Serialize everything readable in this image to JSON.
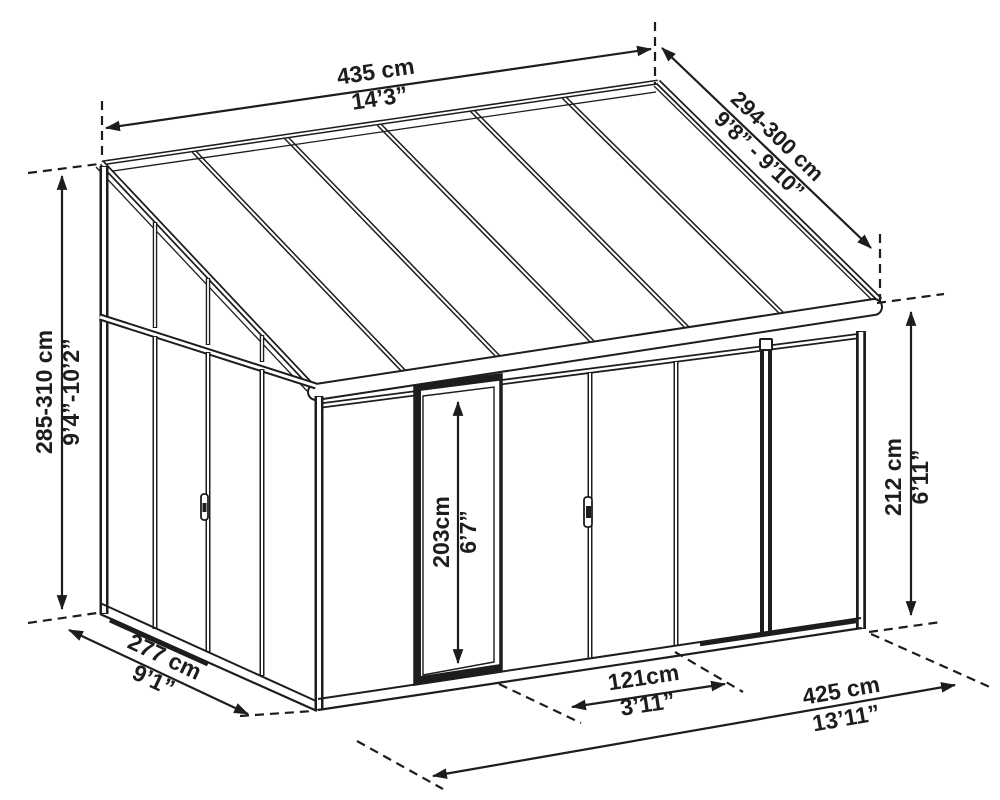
{
  "diagram": {
    "type": "sunroom-dimension-drawing",
    "colors": {
      "line": "#1d1d1b",
      "background": "#ffffff"
    },
    "dimensions": {
      "roof_width": {
        "metric": "435 cm",
        "imperial": "14’3”"
      },
      "roof_depth": {
        "metric": "294-300 cm",
        "imperial": "9’8” - 9’10”"
      },
      "back_height": {
        "metric": "285-310 cm",
        "imperial": "9’4”-10’2”"
      },
      "front_height": {
        "metric": "212 cm",
        "imperial": "6’11”"
      },
      "door_height": {
        "metric": "203cm",
        "imperial": "6’7”"
      },
      "door_width": {
        "metric": "121cm",
        "imperial": "3’11”"
      },
      "side_depth": {
        "metric": "277 cm",
        "imperial": "9’1”"
      },
      "floor_width": {
        "metric": "425 cm",
        "imperial": "13’11”"
      }
    }
  }
}
